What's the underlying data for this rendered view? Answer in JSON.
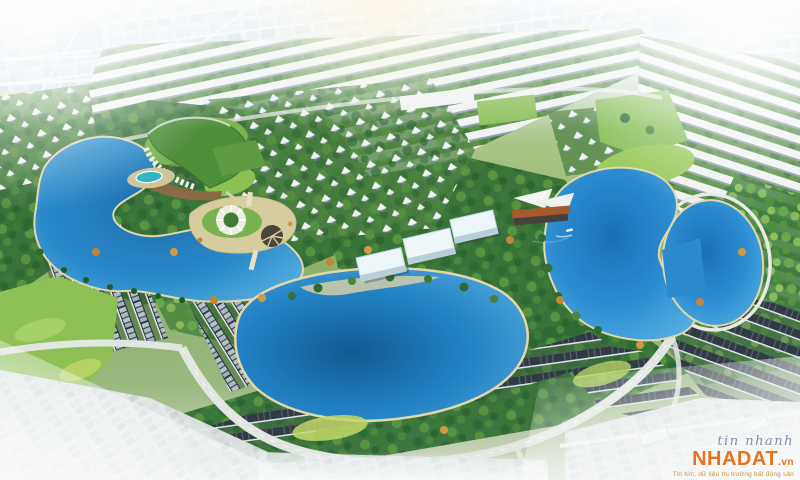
{
  "image": {
    "type": "aerial-3d-masterplan-rendering",
    "subject": "Lakeside residential urban-area master plan, bird's-eye perspective",
    "features": [
      "left-lake",
      "clubhouse-green-roof",
      "swimming-pool",
      "lotus-island-plaza",
      "center-lake",
      "community-halls",
      "right-lake",
      "lakeside-pavilion",
      "boat",
      "shophouse-rows",
      "villa-quarters",
      "dark-roof-townhouse-rows",
      "central-park",
      "perimeter-curved-road",
      "existing-town-edges",
      "hazy-city-horizon"
    ]
  },
  "watermark": {
    "line1": "tin nhanh",
    "brand": "NHADAT",
    "suffix": ".vn",
    "tagline": "Tin tức, dữ liệu thị trường bất động sản"
  },
  "colors": {
    "haze": "#f3f6f6",
    "city_block": "#bfd4e0",
    "lake_edge": "#4aa6dc",
    "lake_deep": "#17639f",
    "shoreline_sand": "#e0d7ae",
    "grass_bright": "#8fc055",
    "lawn_yellow": "#c3d968",
    "tree_dark": "#2f6b33",
    "tree_light": "#69a84e",
    "tree_autumn": "#c08538",
    "roof_white": "#f0f3f1",
    "roof_dark": "#2c3540",
    "road_light": "#e2e6e1",
    "building_white": "#ecf5f7",
    "roof_orange": "#a65a2a",
    "pool_teal": "#2fb4c6",
    "watermark_name": "#7d90a4",
    "watermark_brand": "#e8721c",
    "watermark_tagline": "#d8922f"
  }
}
